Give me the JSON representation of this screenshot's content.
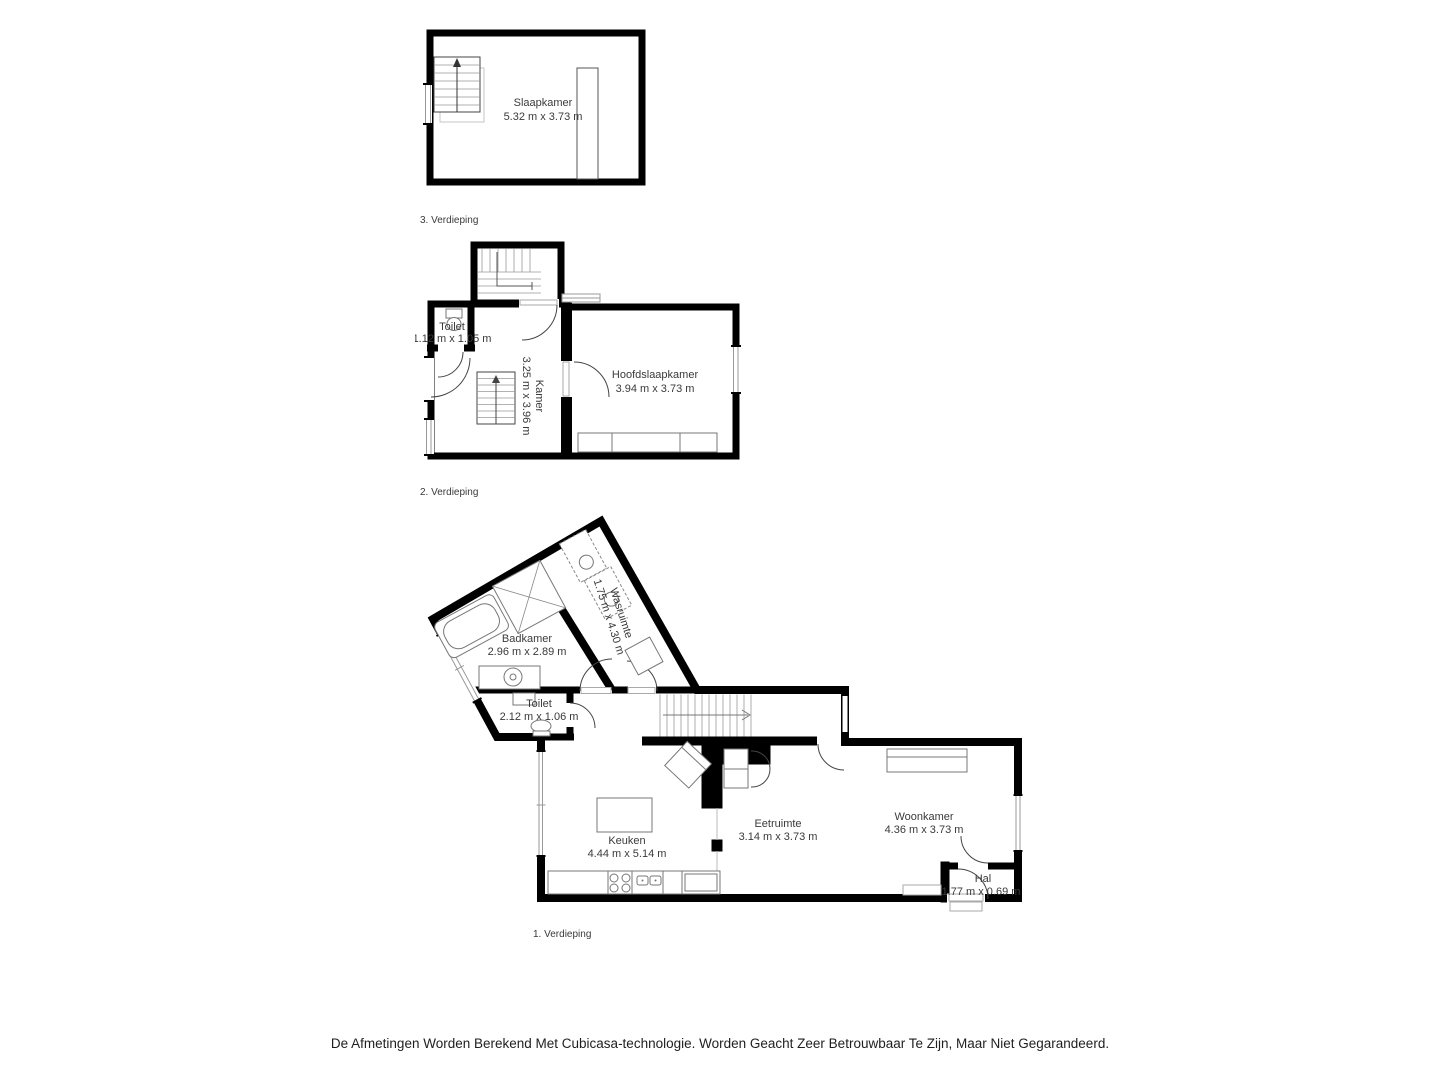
{
  "floors": [
    {
      "label": "3. Verdieping",
      "rooms": [
        {
          "name": "Slaapkamer",
          "dims": "5.32 m x 3.73 m"
        }
      ]
    },
    {
      "label": "2. Verdieping",
      "rooms": [
        {
          "name": "Toilet",
          "dims": "1.12 m x 1.05 m"
        },
        {
          "name": "Kamer",
          "dims": "3.25 m x 3.96 m"
        },
        {
          "name": "Hoofdslaapkamer",
          "dims": "3.94 m x 3.73 m"
        }
      ]
    },
    {
      "label": "1. Verdieping",
      "rooms": [
        {
          "name": "Badkamer",
          "dims": "2.96 m x 2.89 m"
        },
        {
          "name": "Wasruimte",
          "dims": "1.75 m x 4.30 m"
        },
        {
          "name": "Toilet",
          "dims": "2.12 m x 1.06 m"
        },
        {
          "name": "Keuken",
          "dims": "4.44 m x 5.14 m"
        },
        {
          "name": "Eetruimte",
          "dims": "3.14 m x 3.73 m"
        },
        {
          "name": "Woonkamer",
          "dims": "4.36 m x 3.73 m"
        },
        {
          "name": "Hal",
          "dims": "1.77 m x 0.69 m"
        }
      ]
    }
  ],
  "disclaimer": "De Afmetingen Worden Berekend Met Cubicasa-technologie. Worden Geacht Zeer Betrouwbaar Te Zijn, Maar Niet Gegarandeerd.",
  "colors": {
    "wall": "#000000",
    "fixture": "#777777",
    "text": "#3a3a3a"
  }
}
